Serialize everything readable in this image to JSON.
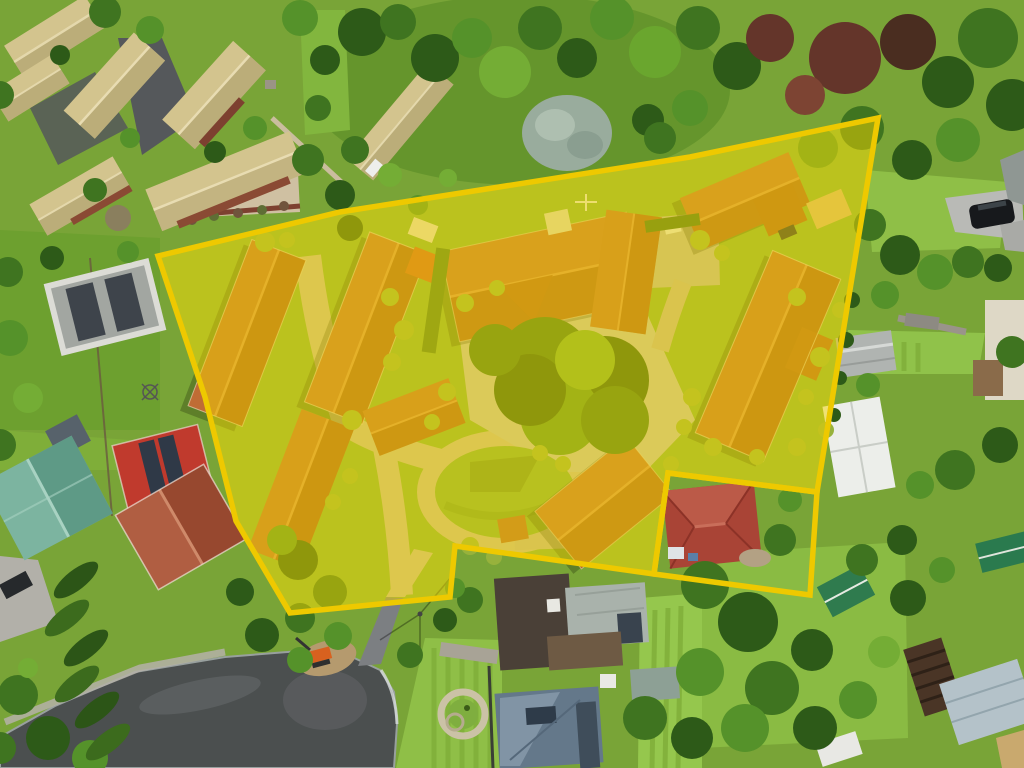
{
  "image": {
    "kind": "aerial drone photograph",
    "subject": "suburban retirement-village style property with multiple terracotta-roofed unit wings, highlighted for sale with a yellow boundary overlay",
    "width_px": 1024,
    "height_px": 768,
    "visible_text": "none"
  },
  "annotation": {
    "boundary": {
      "label": "highlighted-property-boundary",
      "points": "158,256 340,212 690,157 878,118 817,492 668,473 654,574 455,546 450,597 290,613 236,521 205,397",
      "fill": "#f2d400",
      "fill_opacity": "0.5",
      "stroke": "#eec900",
      "stroke_width": "5.5"
    },
    "excluded_parcel": {
      "label": "outlined-parcel-red-roof-house-unshaded",
      "points": "668,473 817,492 810,595 654,574",
      "fill": "none",
      "stroke": "#eec900",
      "stroke_width": "5.5"
    }
  },
  "scene": {
    "inside_boundary": "complex of terracotta-tile roofed unit wings around a central courtyard with large tree, circular lawn, tan internal driveways, shrubs, small orange outbuilding, parking pad with cars",
    "excluded_parcel_content": "brick-red hip-roof house with white car",
    "outside": "khaki-roofed unit buildings top-left, dense trees, neighbouring houses (teal, terracotta, slate, dark brown, grey roofs), red shed with solar panels, grey shed with panels, cypress hedge row, cul-de-sac road at bottom with digger, stone paver circle, green sheds and pergola bottom-right, dark SUV on right driveway"
  },
  "palette": {
    "overlay_yellow": "#f2d400",
    "outline_yellow": "#eec900",
    "grass_base": "#79a437",
    "terracotta_roof": "#bf6c35",
    "khaki_roof": "#d3c48e",
    "asphalt": "#4a4d50"
  }
}
